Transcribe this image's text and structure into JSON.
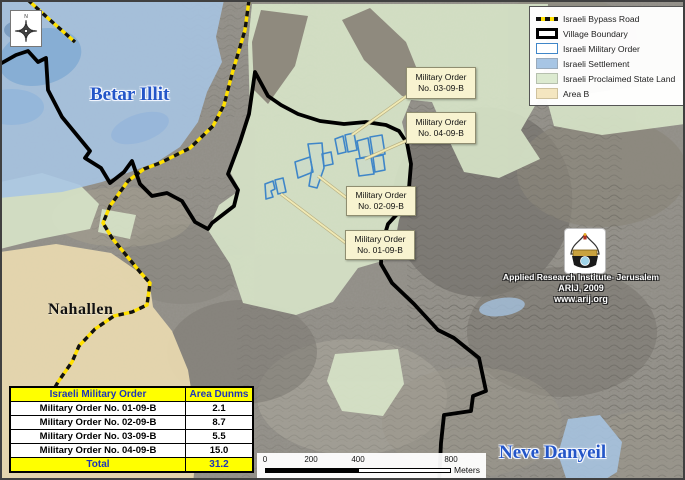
{
  "map_labels": {
    "settlement_top_left": "Betar Illit",
    "village_bottom_left": "Nahallen",
    "settlement_bottom_right": "Neve Danyeil"
  },
  "callouts": [
    {
      "line1": "Military Order",
      "line2": "No. 03-09-B"
    },
    {
      "line1": "Military Order",
      "line2": "No. 04-09-B"
    },
    {
      "line1": "Military Order",
      "line2": "No. 02-09-B"
    },
    {
      "line1": "Military Order",
      "line2": "No. 01-09-B"
    }
  ],
  "legend": {
    "items": [
      {
        "label": "Israeli Bypass Road"
      },
      {
        "label": "Village Boundary"
      },
      {
        "label": "Israeli Military Order"
      },
      {
        "label": "Israeli Settlement"
      },
      {
        "label": "Israeli Proclaimed State Land"
      },
      {
        "label": "Area B"
      }
    ]
  },
  "credit": {
    "line1": "Applied Research Institute- Jerusalem",
    "line2": "ARIJ, 2009",
    "line3": "www.arij.org"
  },
  "table": {
    "headers": [
      "Israeli Military Order",
      "Area Dunms"
    ],
    "rows": [
      [
        "Military Order No. 01-09-B",
        "2.1"
      ],
      [
        "Military Order No. 02-09-B",
        "8.7"
      ],
      [
        "Military Order No. 03-09-B",
        "5.5"
      ],
      [
        "Military Order No. 04-09-B",
        "15.0"
      ]
    ],
    "total_row": [
      "Total",
      "31.2"
    ]
  },
  "scalebar": {
    "ticks": [
      "0",
      "200",
      "400",
      "800"
    ],
    "unit": "Meters"
  },
  "compass": {
    "north": "N"
  },
  "colors": {
    "settlement": "#a7c5e4",
    "state_land": "#d8e5c9",
    "area_b": "#ecdcb0",
    "military_order": "#3f86c8",
    "bypass_road": "#ffe000",
    "village_boundary": "#000000",
    "callout_bg": "#f8f3d0",
    "table_highlight": "#ffff00",
    "table_header_text": "#1f35b8",
    "label_blue": "#2456c8"
  }
}
